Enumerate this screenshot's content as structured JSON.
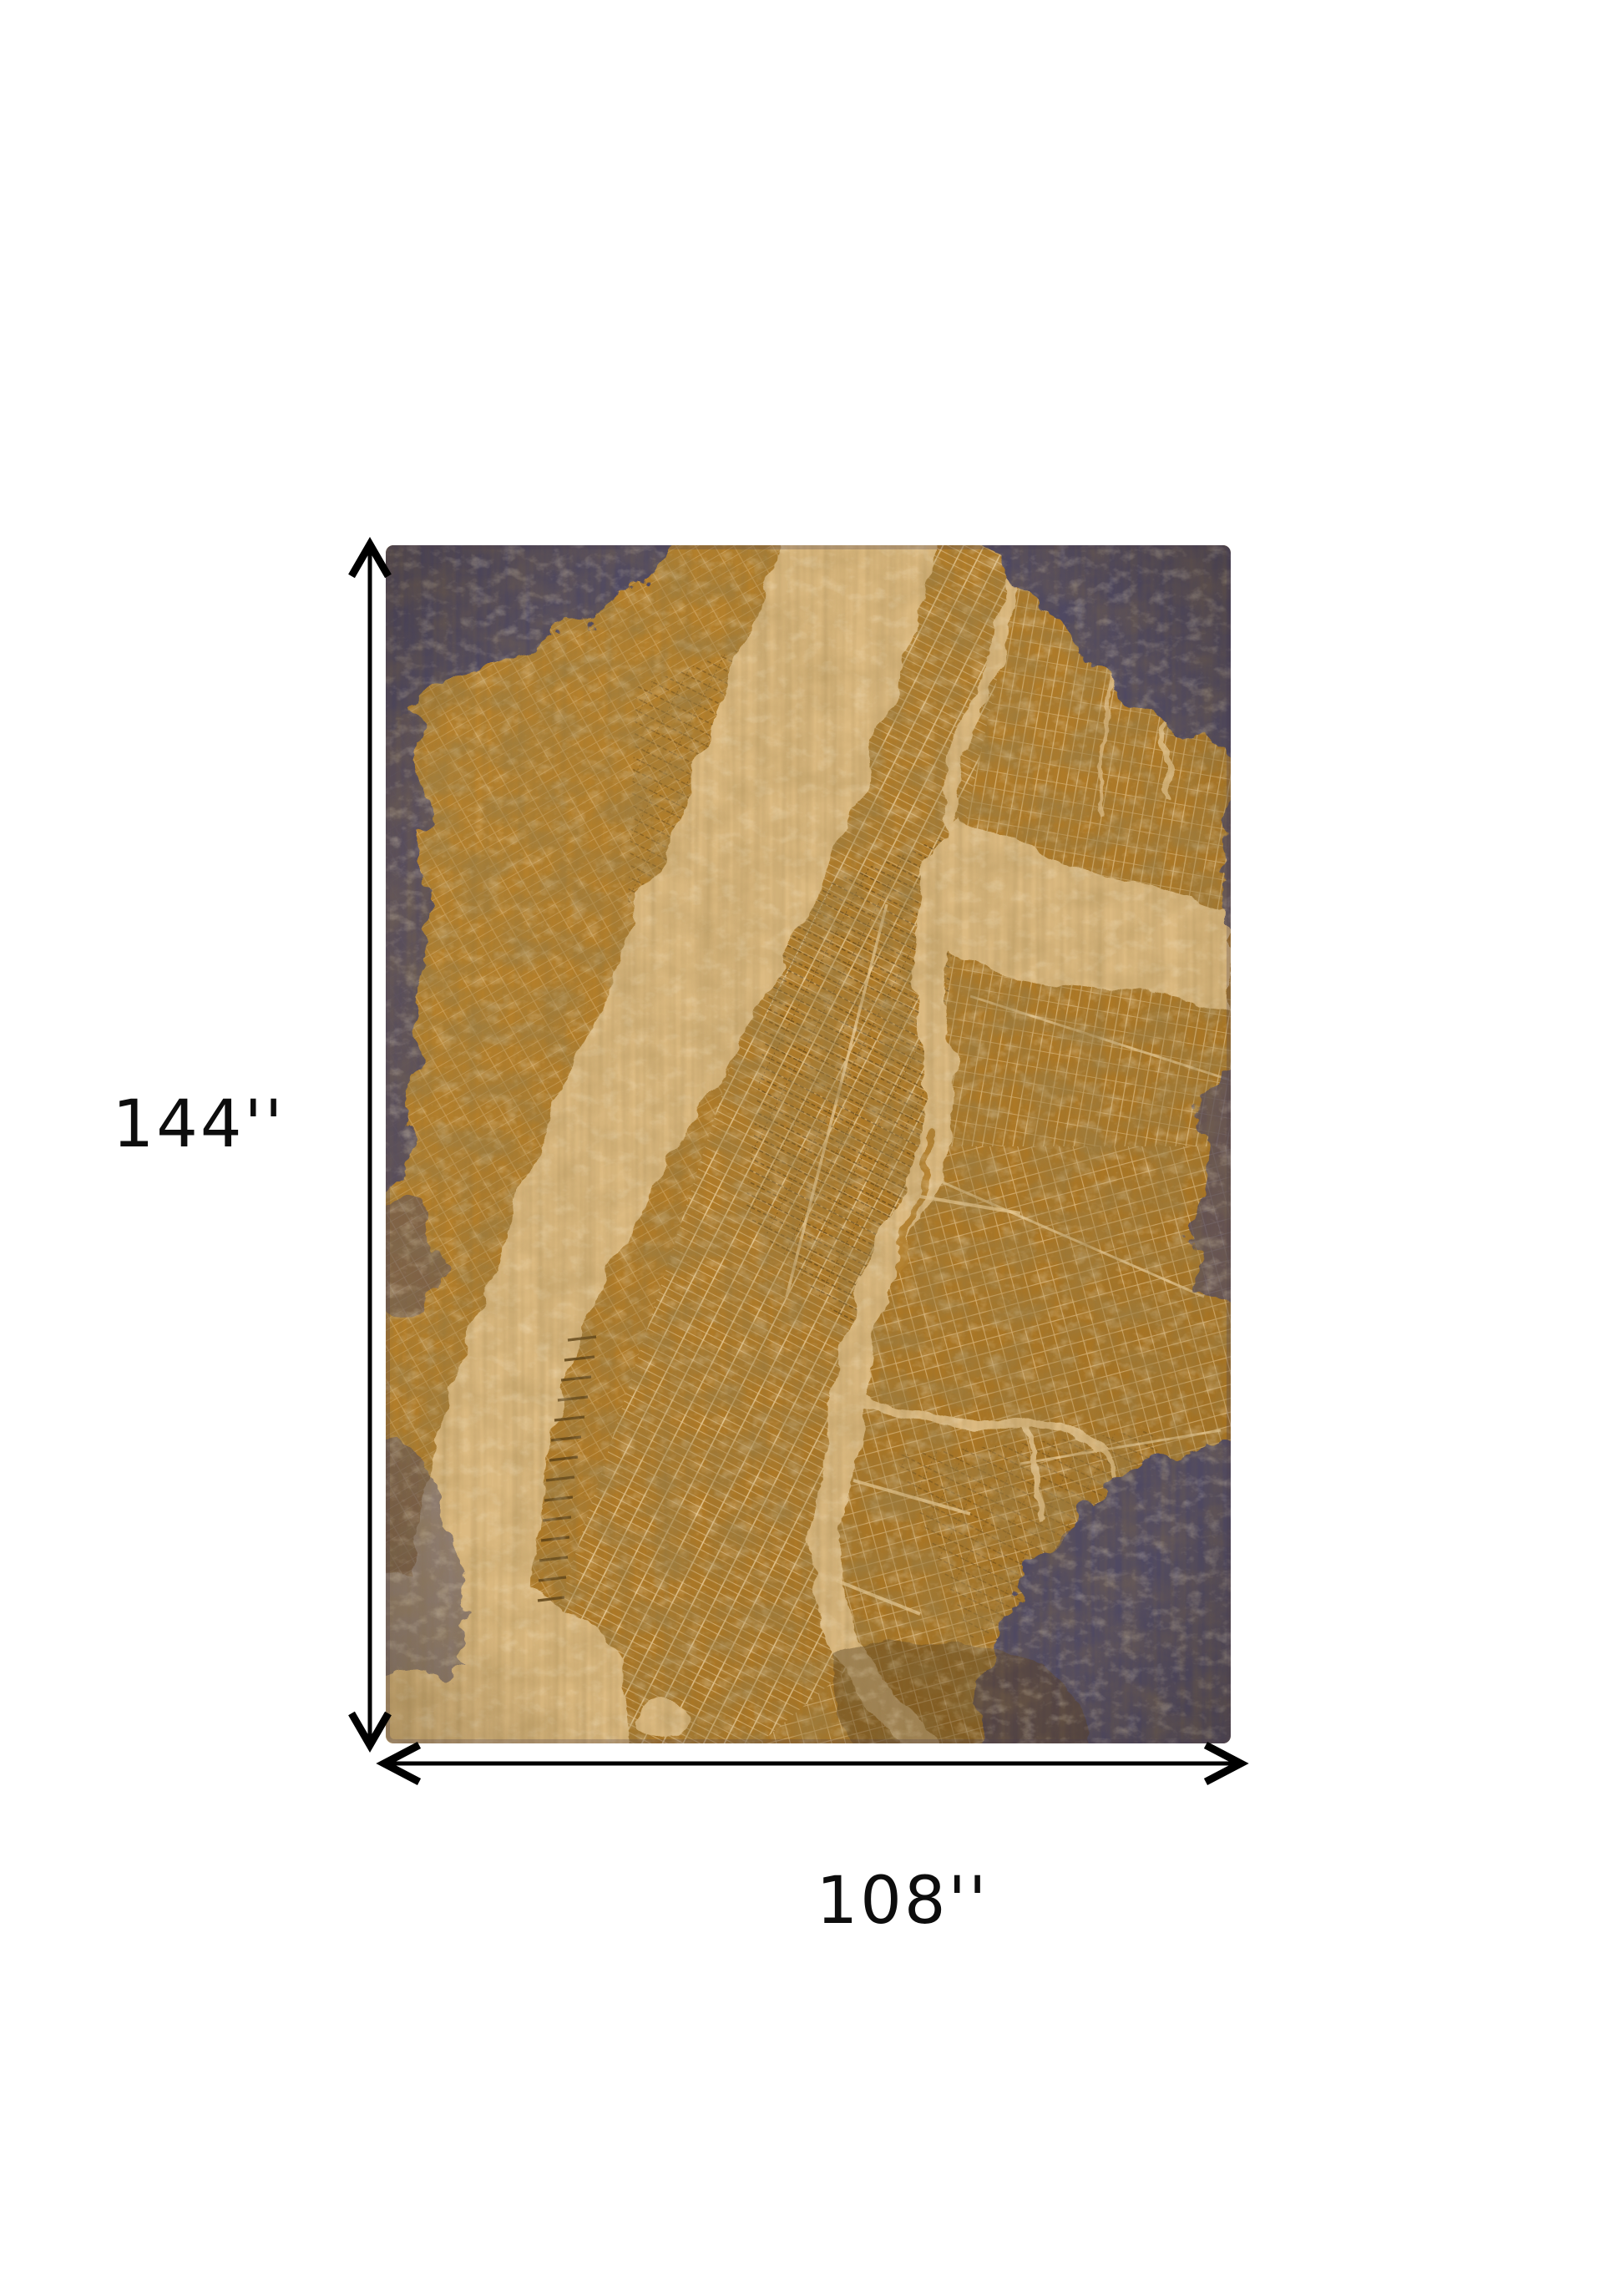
{
  "page": {
    "background_color": "#ffffff"
  },
  "product_image": {
    "type": "rug-dimensions-diagram",
    "rug": {
      "description": "rectangular area rug with distressed city street-map pattern",
      "colors": {
        "amber": "#b5812f",
        "amber_dark": "#8a5f1d",
        "cream_water": "#ddbb82",
        "navy_edge": "#4f4862",
        "street_light": "#e6c893",
        "street_dark": "#5c4013"
      }
    },
    "dimensions": {
      "height_label": "144''",
      "width_label": "108''",
      "arrow_color": "#000000",
      "label_color": "#0d0d0d"
    }
  }
}
